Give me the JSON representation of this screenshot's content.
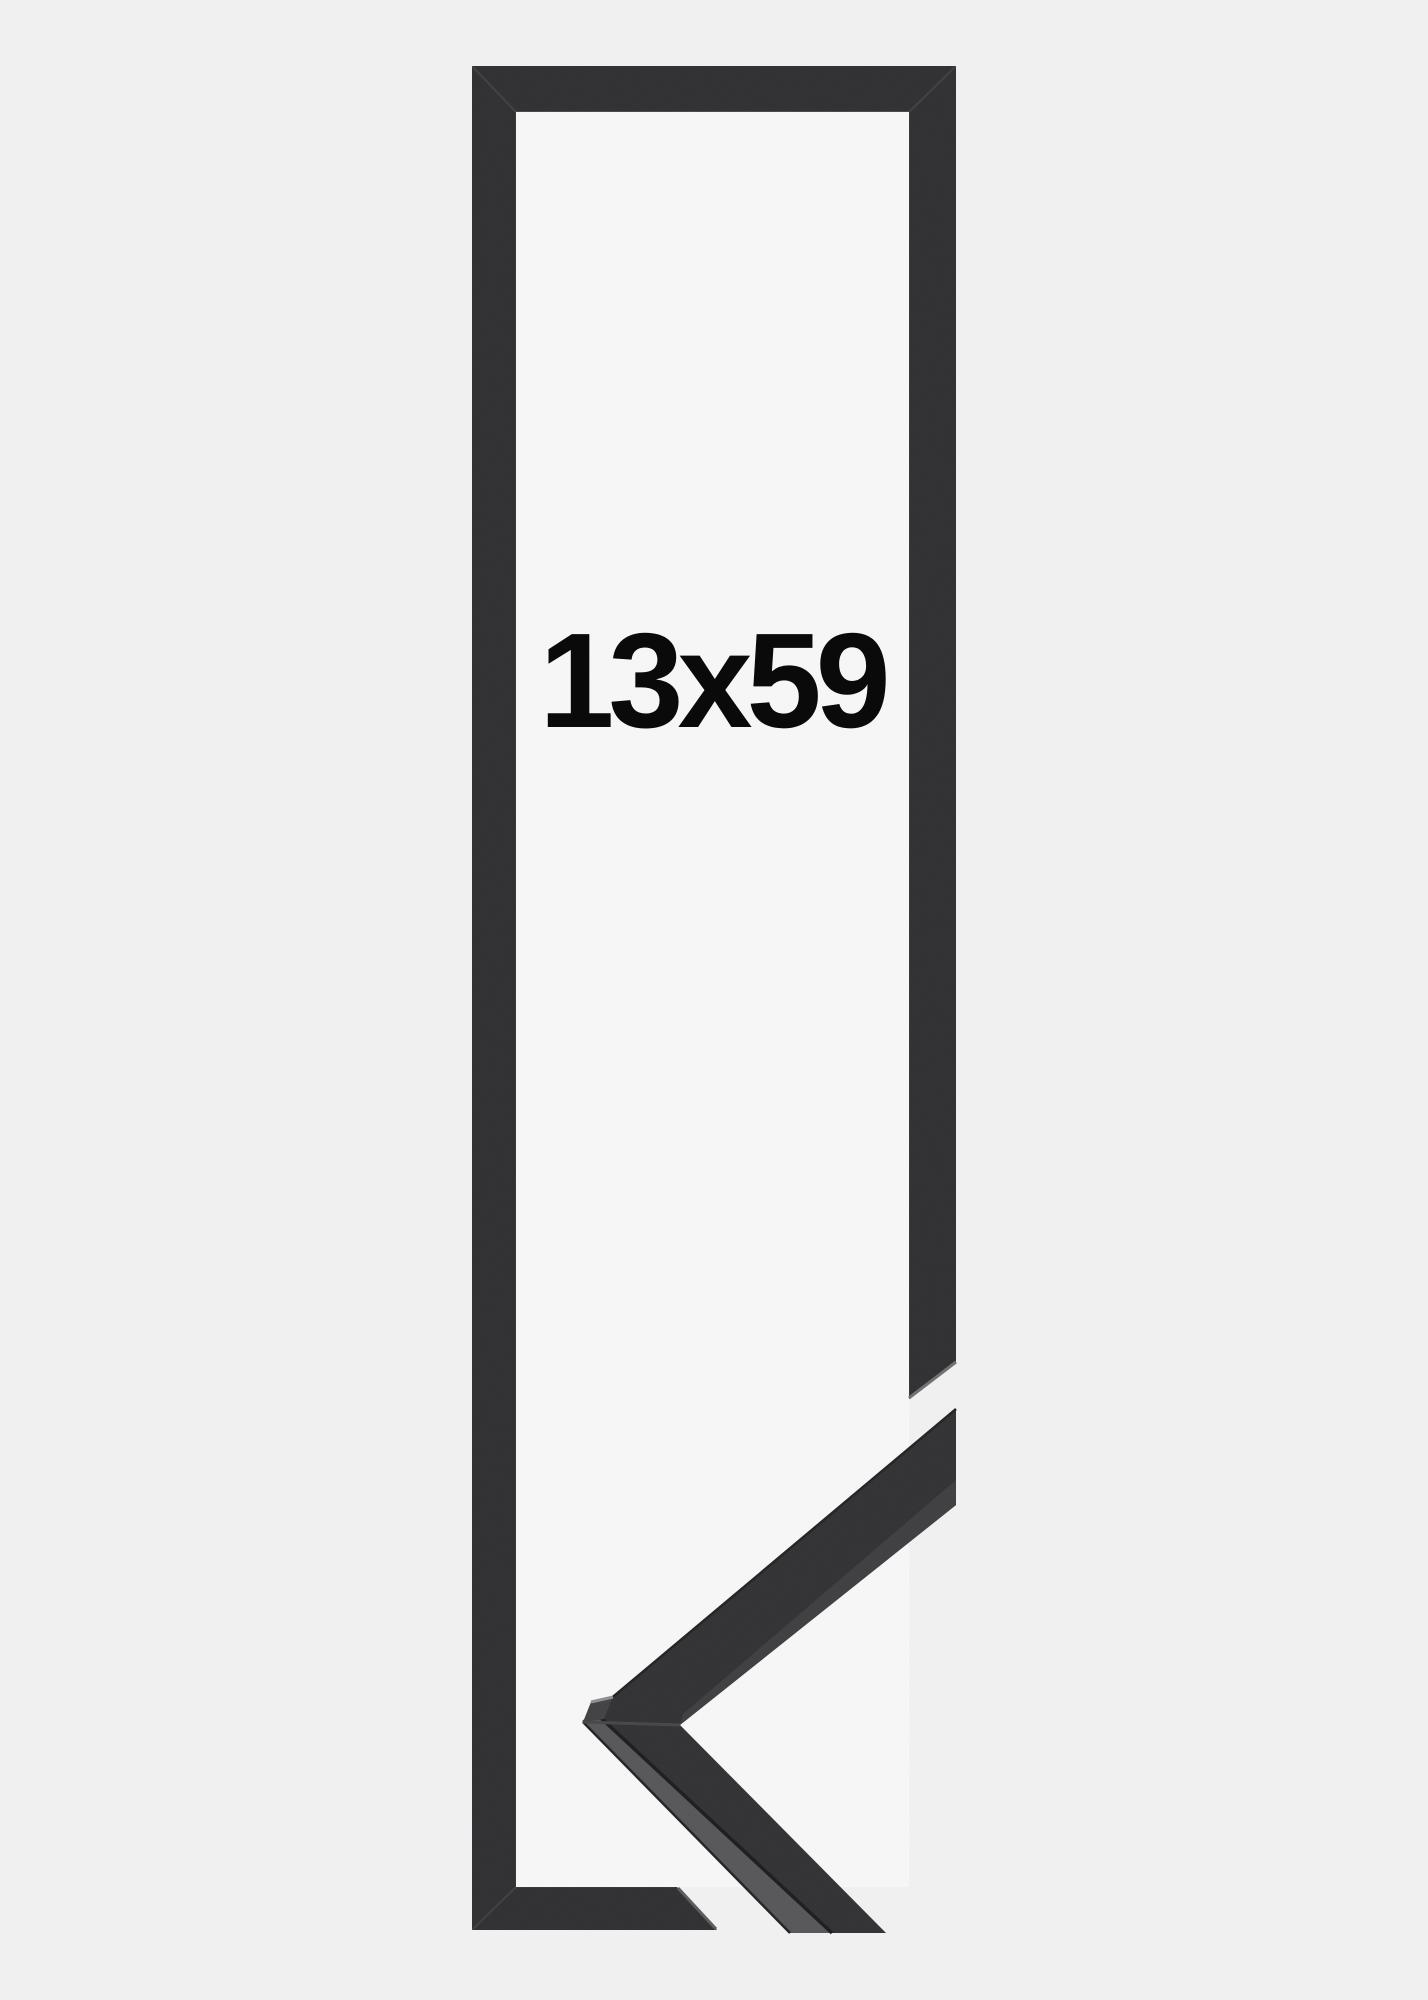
{
  "product": {
    "size_label": "13x59"
  },
  "colors": {
    "background": "#f1f1f2",
    "frame": "#303032",
    "frame_window": "#f7f7f8",
    "label_text": "#0a0a0a",
    "molding_face": "#323234",
    "molding_face_light": "#3f3f42",
    "molding_top_surface": "#57575a",
    "miter_face": "#424245",
    "edge_highlight": "#8f8f92",
    "cut_highlight": "#707073",
    "seam": "#47474a"
  }
}
